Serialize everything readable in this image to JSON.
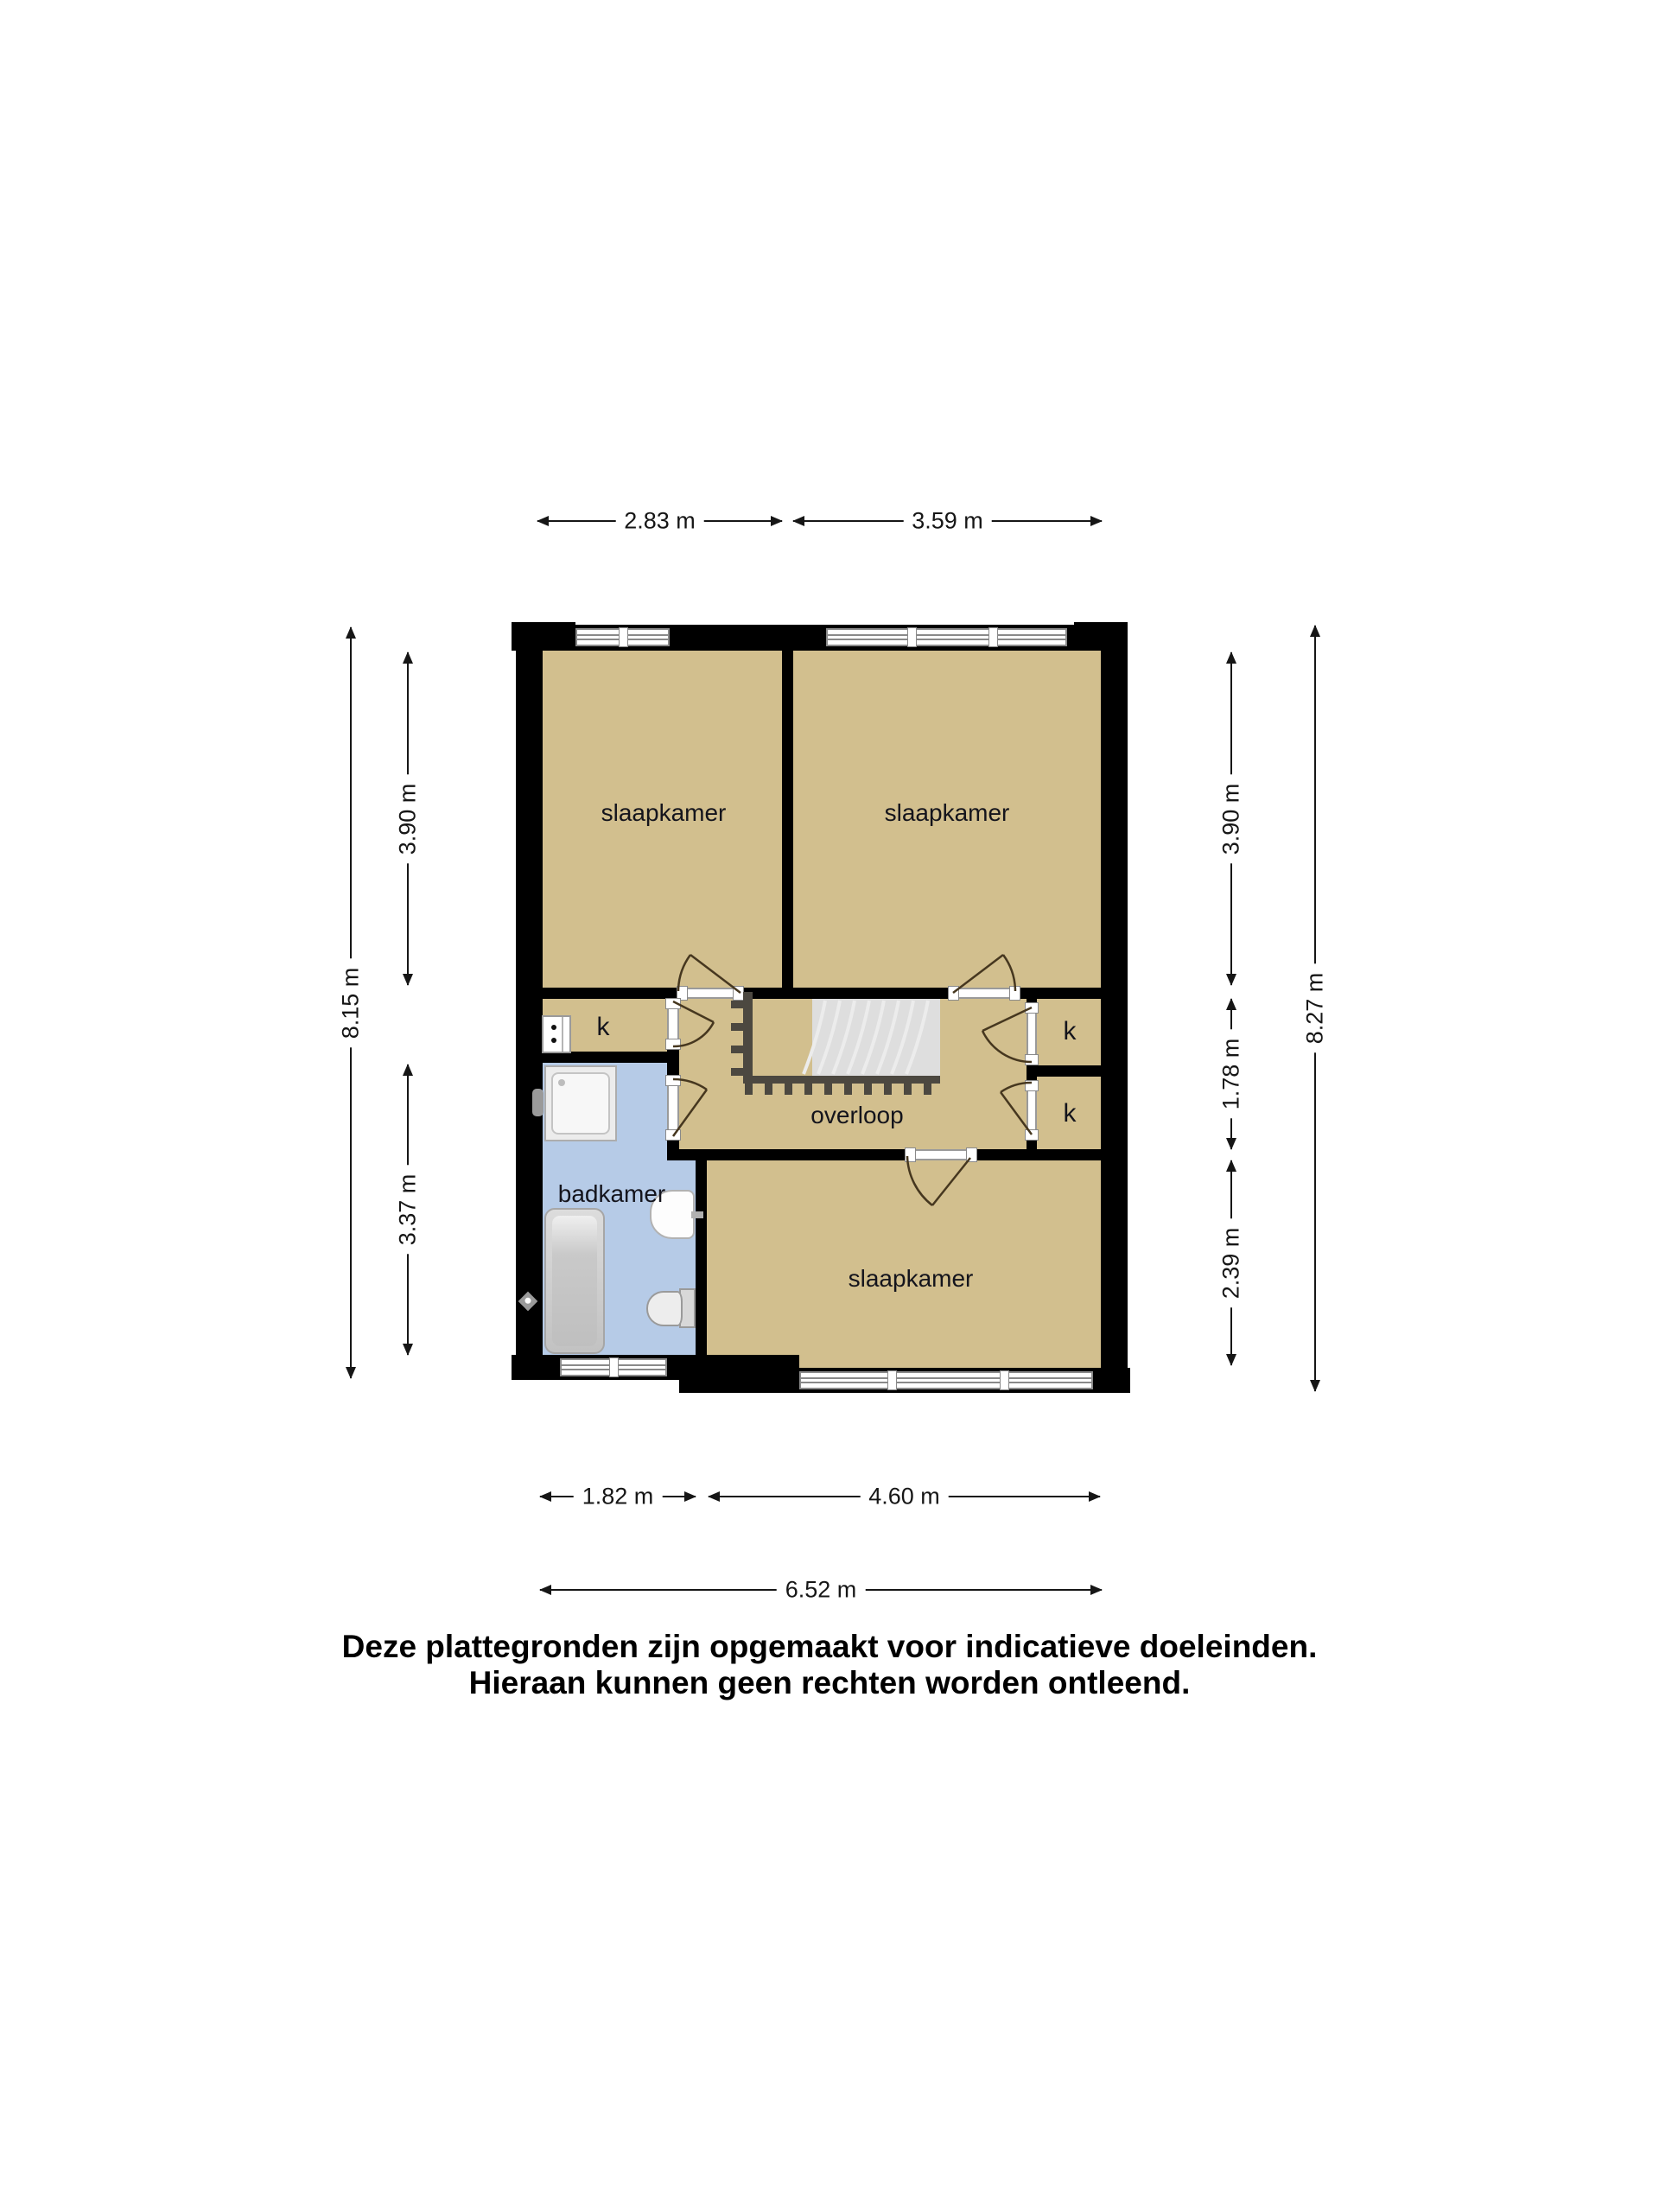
{
  "floorplan": {
    "rooms": {
      "bedroom_top_left": "slaapkamer",
      "bedroom_top_right": "slaapkamer",
      "bedroom_bottom": "slaapkamer",
      "bathroom": "badkamer",
      "landing": "overloop",
      "closet_left": "k",
      "closet_right_top": "k",
      "closet_right_bottom": "k"
    },
    "dimensions": {
      "top": [
        "2.83 m",
        "3.59 m"
      ],
      "bottom_inner": [
        "1.82 m",
        "4.60 m"
      ],
      "bottom_total": "6.52 m",
      "left_inner": [
        "3.90 m",
        "3.37 m"
      ],
      "left_total": "8.15 m",
      "right_inner": [
        "3.90 m",
        "1.78 m",
        "2.39 m"
      ],
      "right_total": "8.27 m"
    },
    "disclaimer": [
      "Deze plattegronden zijn opgemaakt voor indicatieve doeleinden.",
      "Hieraan kunnen geen rechten worden ontleend."
    ],
    "colors": {
      "wall": "#000000",
      "floor": "#d2bf8e",
      "bathroom_floor": "#b6cbe7",
      "dimension_line": "#161616",
      "stair_tread": "#dedede",
      "railing": "#4c4840"
    }
  }
}
